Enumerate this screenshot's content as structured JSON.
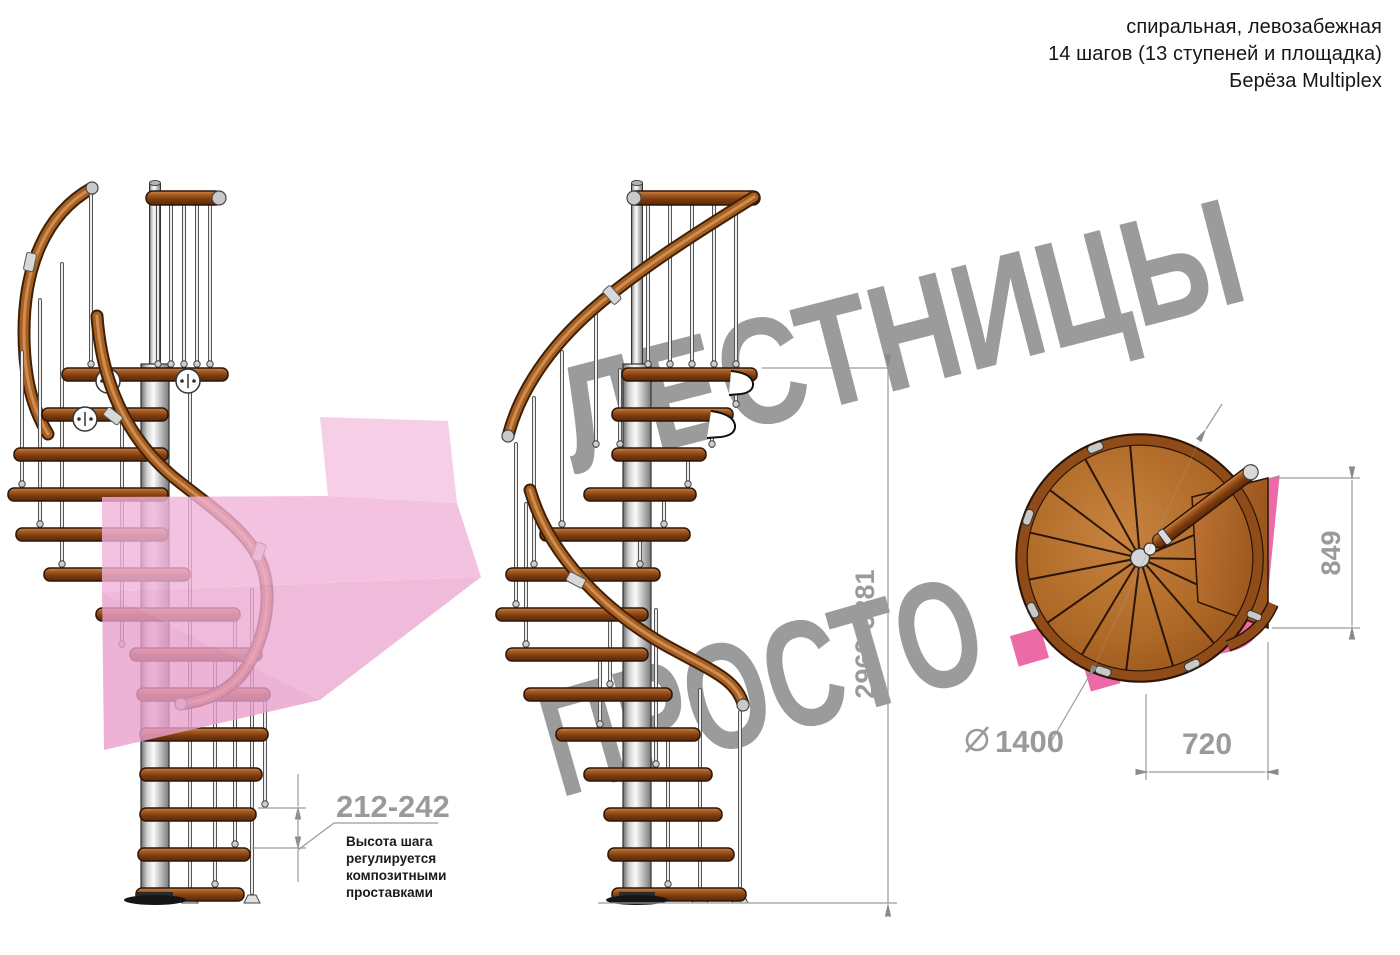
{
  "header": {
    "line1": "спиральная, левозабежная",
    "line2": "14 шагов (13 ступеней и площадка)",
    "line3": "Берёза Multiplex"
  },
  "watermark": {
    "word1": "ЛЕСТНИЦЫ",
    "word2": "ПРОСТО",
    "word2_suffix": ".ру",
    "gray": "#9b9b9b",
    "pink": "#ec6aa6"
  },
  "dimensions": {
    "overall_height": "2969-3381",
    "step_height": "212-242",
    "note_line1": "Высота шага",
    "note_line2": "регулируется",
    "note_line3": "композитными",
    "note_line4": "проставками",
    "diameter_value": "1400",
    "plan_depth": "849",
    "plan_width": "720"
  },
  "colors": {
    "wood": "#a05a24",
    "wood_dark": "#5a2a08",
    "pole_gray": "#d9d9d9",
    "dimension_gray": "#9a9a9a",
    "arrow_pink": "#f1b3d9"
  }
}
